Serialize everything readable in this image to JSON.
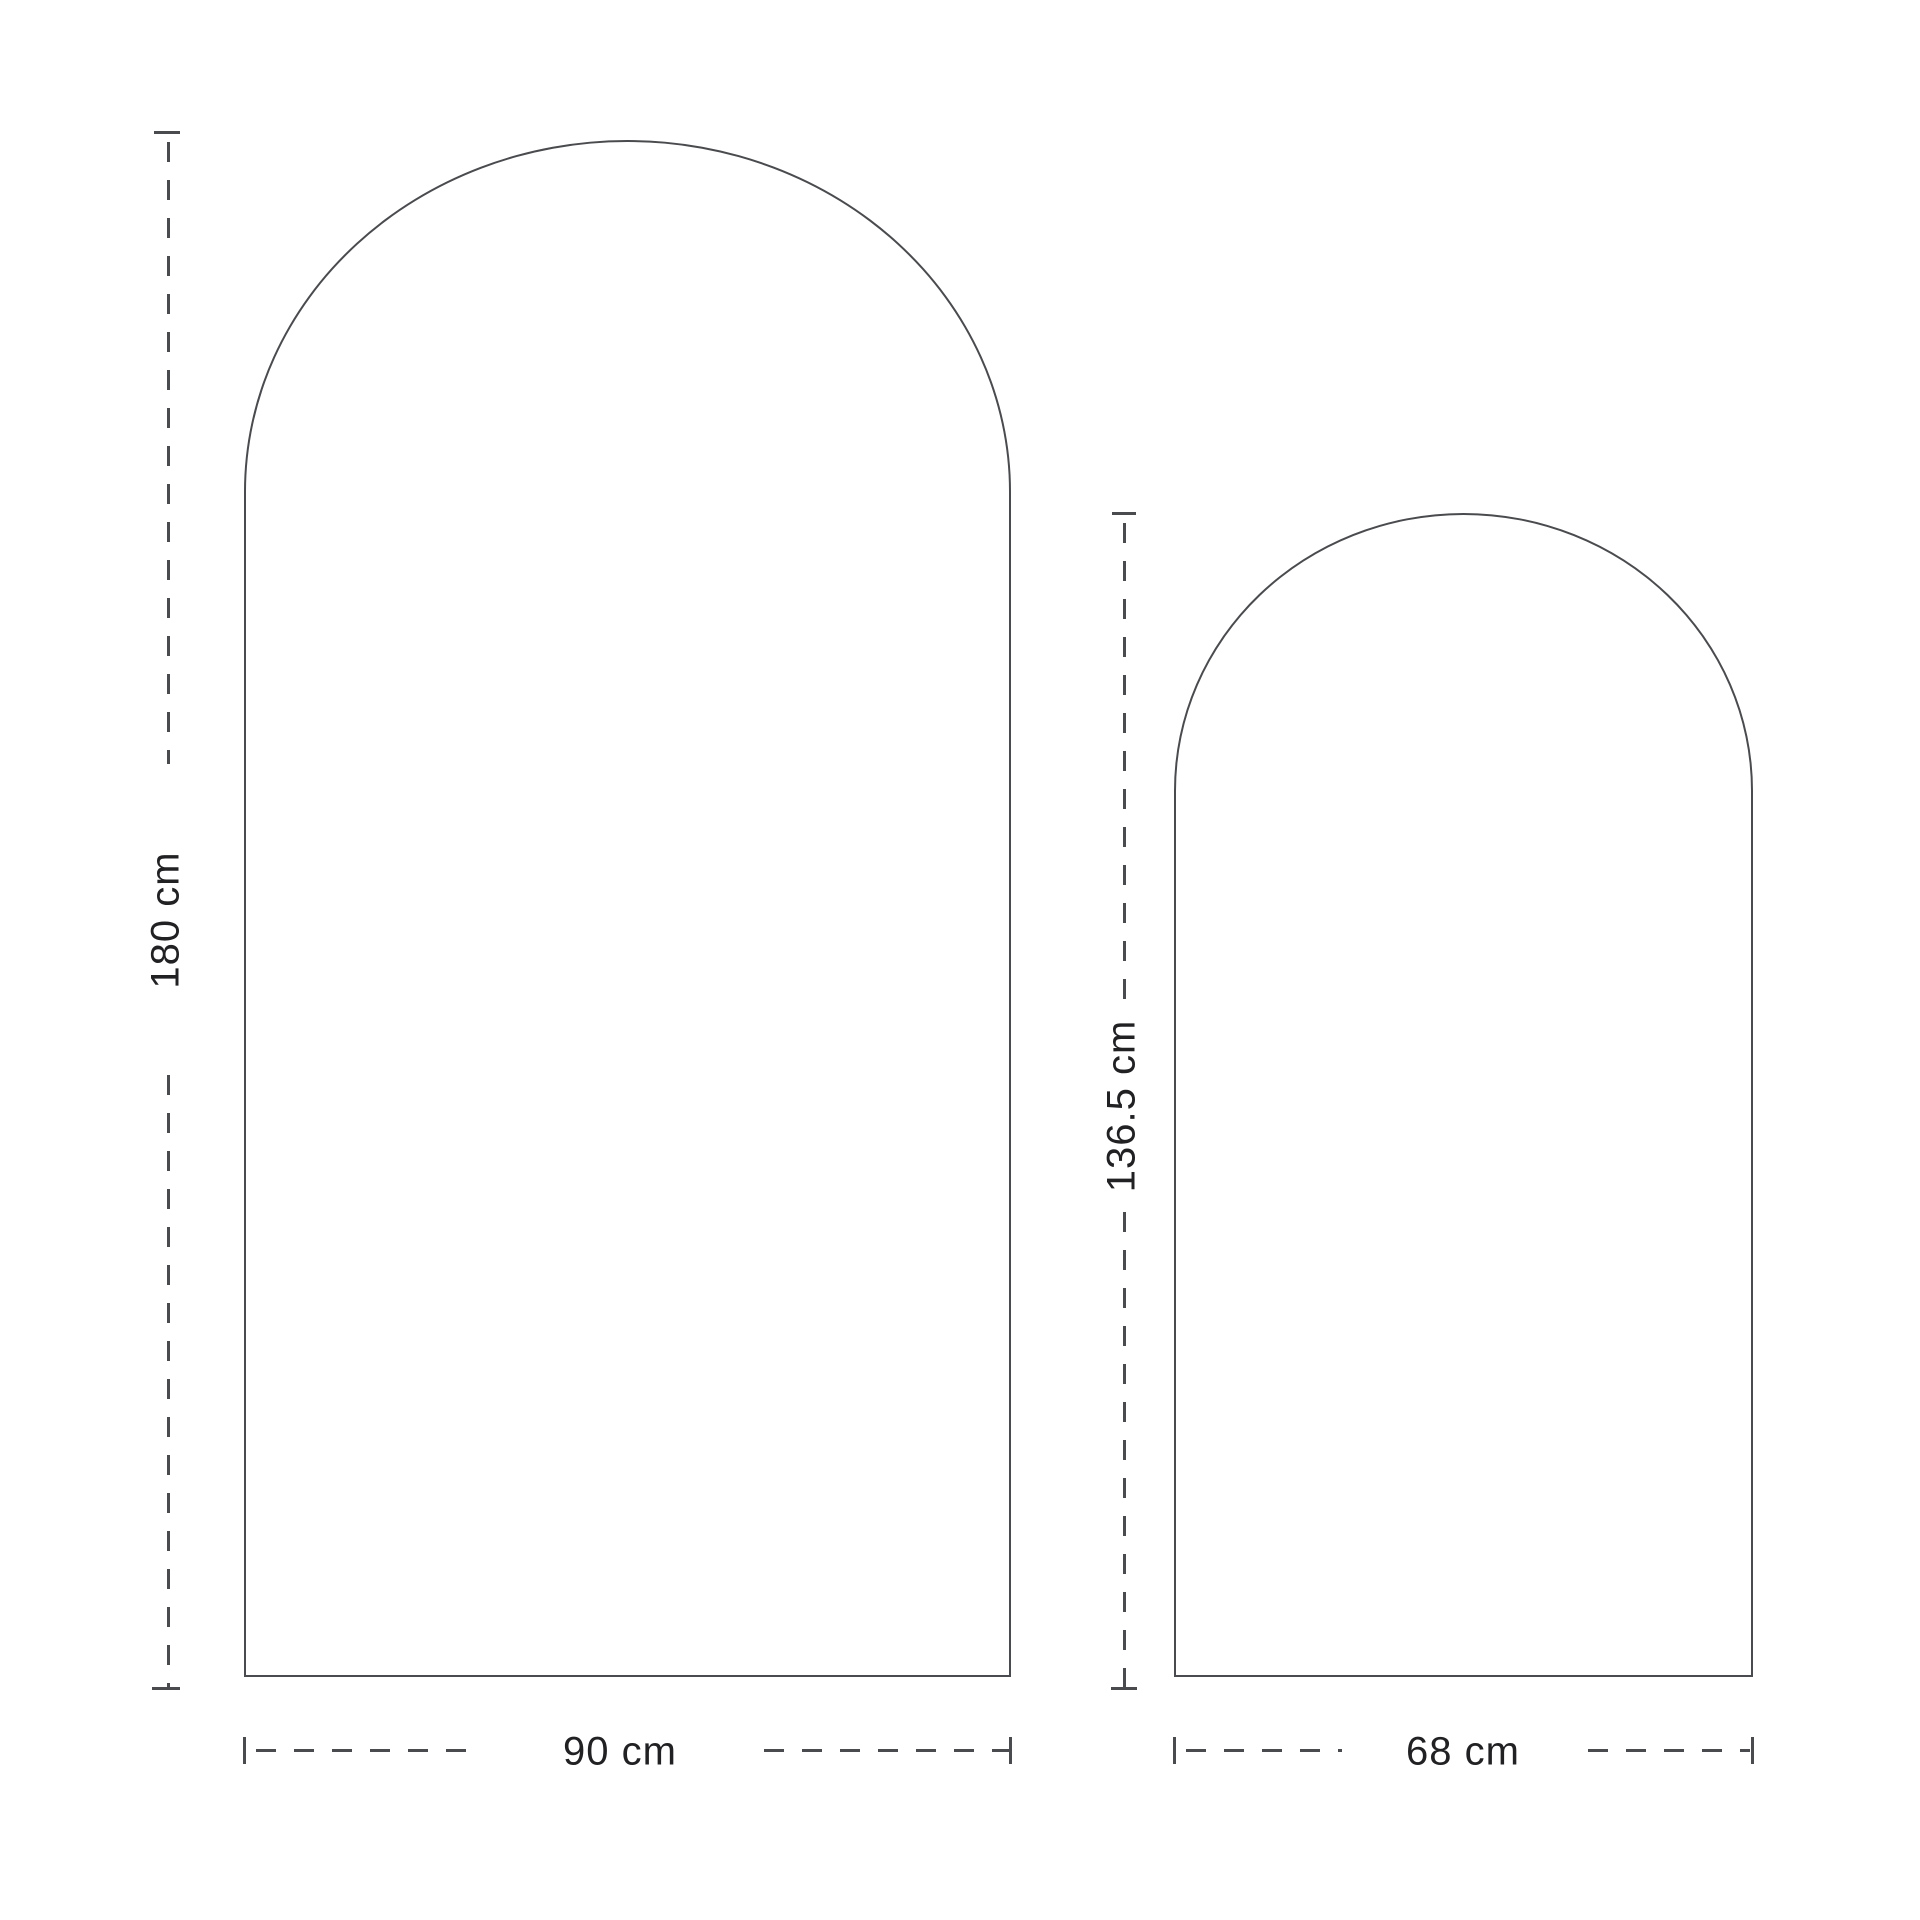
{
  "diagram": {
    "background_color": "#ffffff",
    "line_color": "#4a4b4e",
    "text_color": "#212124",
    "unit": "cm",
    "shapes": [
      {
        "id": "large-arch",
        "height_value": "180",
        "width_value": "90",
        "height_label": "180 cm",
        "width_label": "90 cm"
      },
      {
        "id": "small-arch",
        "height_value": "136.5",
        "width_value": "68",
        "height_label": "136.5 cm",
        "width_label": "68 cm"
      }
    ]
  }
}
